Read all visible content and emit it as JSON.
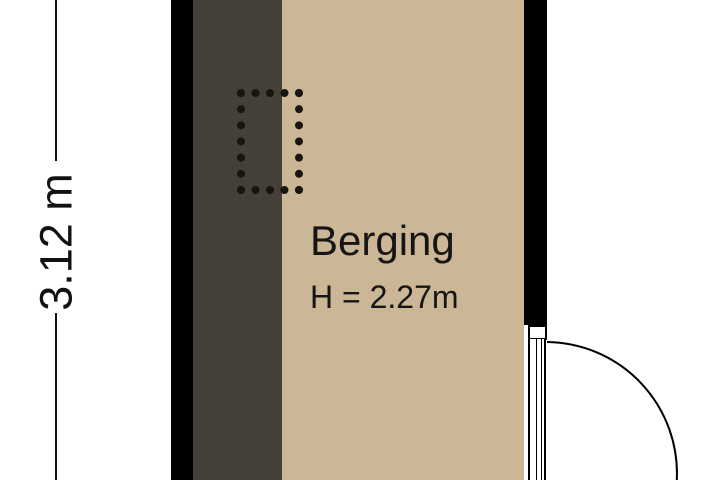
{
  "plan": {
    "room": {
      "name": "Berging",
      "height_label": "H = 2.27m"
    },
    "dimension": {
      "label": "3.12 m",
      "orientation": "vertical"
    },
    "door": {
      "name": "door-swing",
      "swing": "outward-right",
      "position": "bottom-right"
    },
    "fixture": {
      "name": "dashed-outline-fixture"
    },
    "colors": {
      "wall": "#000000",
      "floor_main": "#cbb695",
      "floor_dark_zone": "#444037",
      "background": "#ffffff",
      "line": "#111111",
      "text": "#151515"
    }
  }
}
